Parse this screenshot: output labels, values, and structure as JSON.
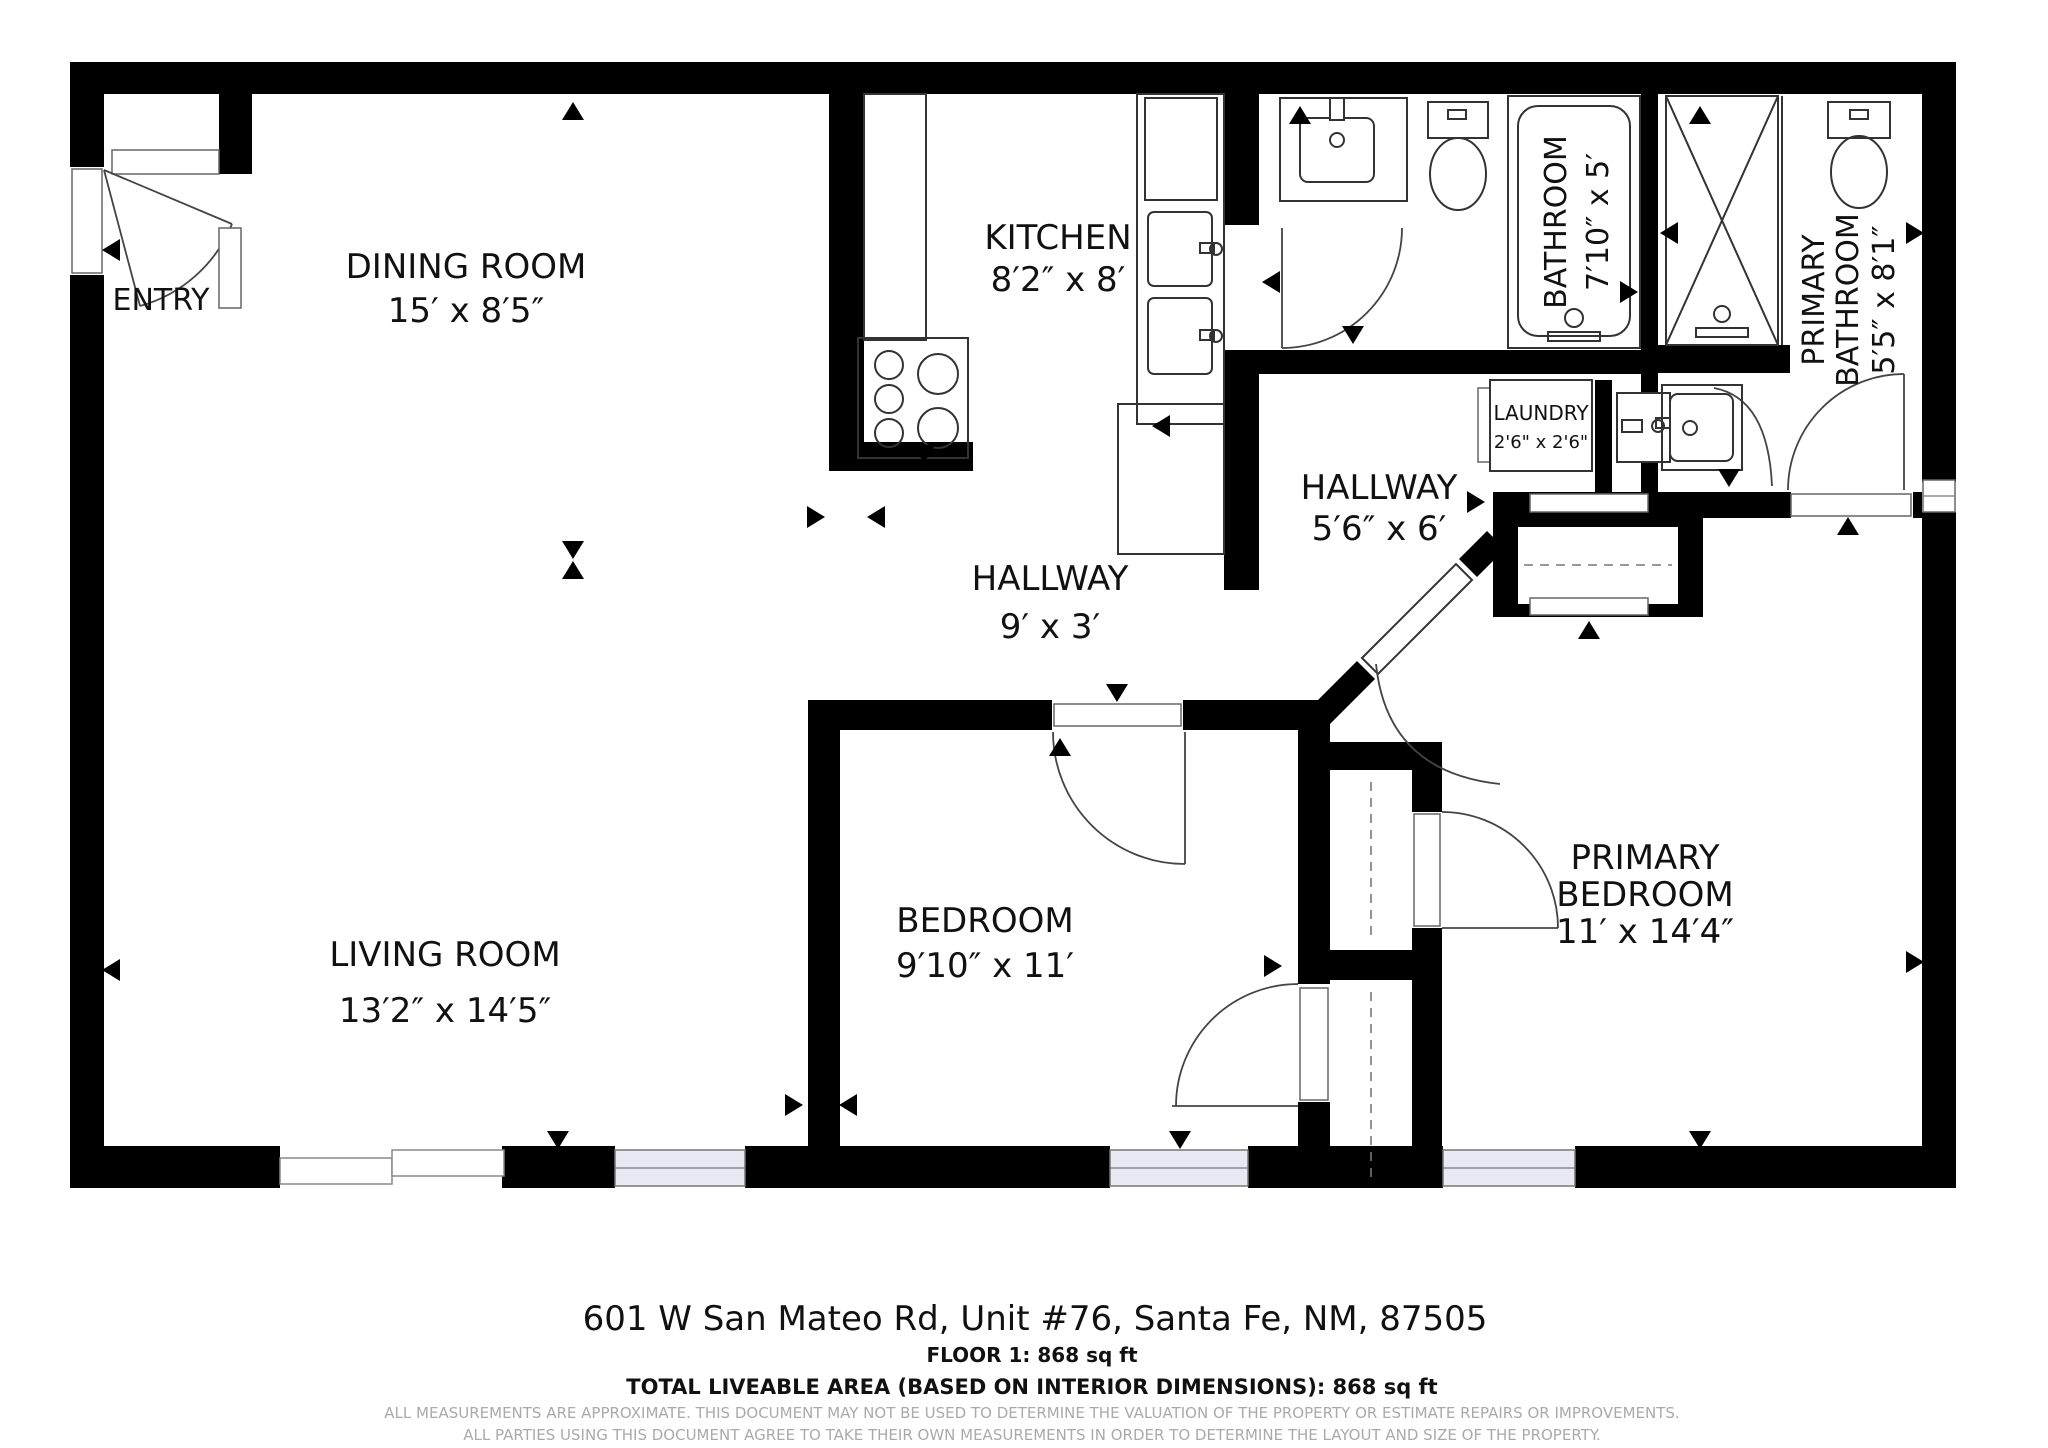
{
  "rooms": {
    "entry": {
      "name": "ENTRY"
    },
    "dining": {
      "name": "DINING ROOM",
      "dims": "15′ x 8′5″"
    },
    "kitchen": {
      "name": "KITCHEN",
      "dims": "8′2″ x 8′"
    },
    "hallway_main": {
      "name": "HALLWAY",
      "dims": "9′ x 3′"
    },
    "hallway_rear": {
      "name": "HALLWAY",
      "dims": "5′6″ x 6′"
    },
    "laundry": {
      "name": "LAUNDRY",
      "dims": "2'6\" x 2'6\""
    },
    "bathroom": {
      "name": "BATHROOM",
      "dims": "7′10″ x 5′"
    },
    "primary_bathroom": {
      "name1": "PRIMARY",
      "name2": "BATHROOM",
      "dims": "5′5″ x 8′1″"
    },
    "living": {
      "name": "LIVING ROOM",
      "dims": "13′2″ x 14′5″"
    },
    "bedroom": {
      "name": "BEDROOM",
      "dims": "9′10″ x 11′"
    },
    "primary_bedroom": {
      "name1": "PRIMARY",
      "name2": "BEDROOM",
      "dims": "11′ x 14′4″"
    }
  },
  "footer": {
    "address": "601 W San Mateo Rd, Unit #76, Santa Fe, NM, 87505",
    "floor_area": "FLOOR 1: 868 sq ft",
    "total_area": "TOTAL LIVEABLE AREA (BASED ON INTERIOR DIMENSIONS): 868 sq ft",
    "disclaimer1": "ALL MEASUREMENTS ARE APPROXIMATE. THIS DOCUMENT MAY NOT BE USED TO DETERMINE THE VALUATION OF THE PROPERTY OR ESTIMATE REPAIRS OR IMPROVEMENTS.",
    "disclaimer2": "ALL PARTIES USING THIS DOCUMENT AGREE TO TAKE THEIR OWN MEASUREMENTS IN ORDER TO DETERMINE THE LAYOUT AND SIZE OF THE PROPERTY."
  }
}
